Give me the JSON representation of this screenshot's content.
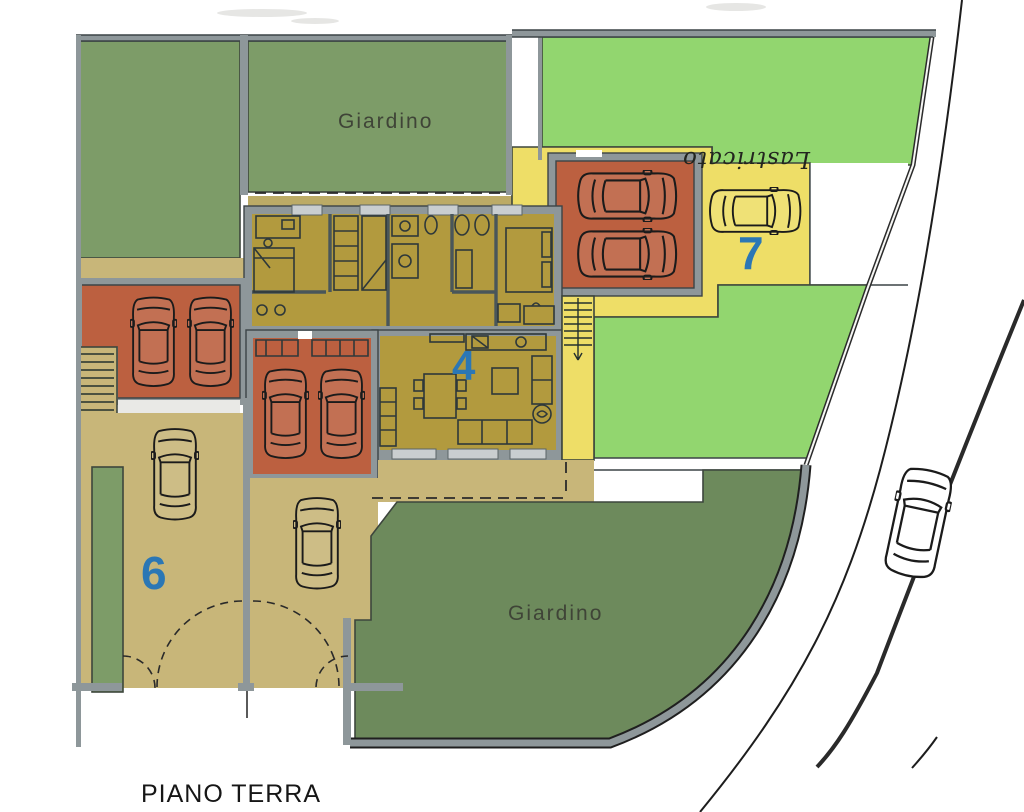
{
  "plan": {
    "labels": {
      "garden_top": "Giardino",
      "garden_bottom": "Giardino",
      "unit_4": "4",
      "unit_6": "6",
      "unit_7": "7",
      "handwritten_note": "Lastricato",
      "plan_title": "PIANO TERRA"
    },
    "colors": {
      "garden_dark": "#7d9c68",
      "garden_bottom": "#6d8a5c",
      "garden_bright": "#92d66f",
      "floor_mustard": "#b29a3e",
      "paving_yellow": "#eede67",
      "paving_tan": "#c8b679",
      "paving_tan2": "#bcab66",
      "garage_orange": "#bc6040",
      "wall_gray": "#8e979a",
      "accent_blue": "#2b77b5"
    },
    "icons": {
      "cars": "car-top-view-icon",
      "stairs": "staircase-icon",
      "gates": "dashed-gate-swing-arc"
    }
  }
}
